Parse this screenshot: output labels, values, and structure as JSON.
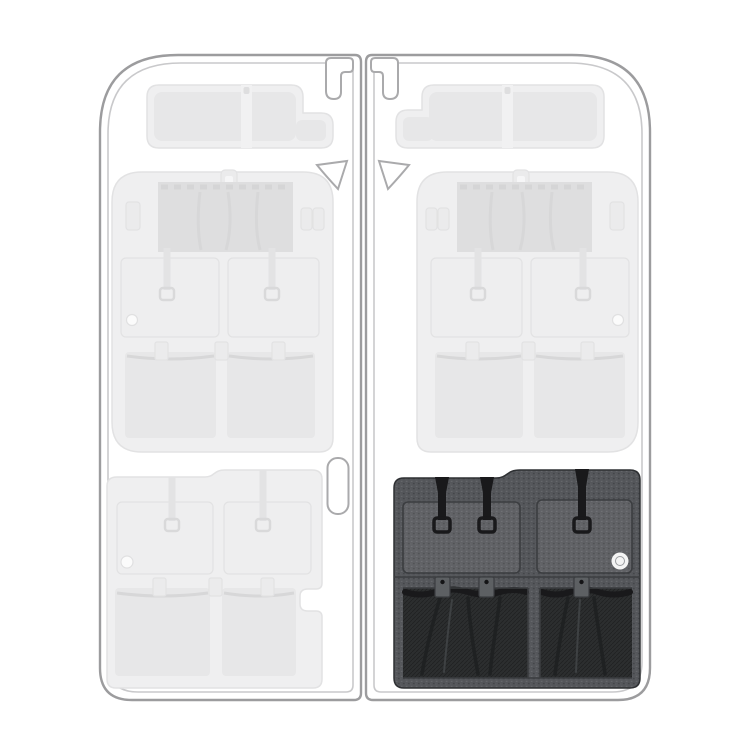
{
  "image": {
    "width": 750,
    "height": 750,
    "kind": "van-rear-door-organizer-placement-diagram"
  },
  "doors": {
    "left": {
      "state": "ghosted",
      "panels": [
        "top-shelf-organizer",
        "middle-door-organizer",
        "bottom-door-organizer"
      ],
      "hardware": [
        "door-check-bracket",
        "wedge-bumper",
        "handle-recess"
      ]
    },
    "right": {
      "state": "ghosted",
      "panels": [
        "top-shelf-organizer",
        "middle-door-organizer"
      ],
      "highlighted_panel": "bottom-door-organizer",
      "hardware": [
        "door-check-bracket",
        "wedge-bumper"
      ]
    }
  },
  "highlighted_panel": {
    "position": "right-door-bottom",
    "features": [
      "flap-pocket-left",
      "flap-pocket-right",
      "webbing-straps",
      "strap-loops",
      "brand-badge",
      "mesh-pocket-left",
      "mesh-pocket-right",
      "snap-tabs"
    ]
  },
  "badge": {
    "shape": "circle"
  },
  "colors": {
    "background": "#ffffff",
    "door_outline": "#9c9c9e",
    "door_outline_inner": "#c9c9cb",
    "hardware_stroke": "#aaaaac",
    "ghost_fill": "#efeff0",
    "ghost_inner": "#e7e7e8",
    "ghost_accent": "#dededf",
    "ghost_stroke": "#e2e2e3",
    "panel_fabric": "#54565a",
    "panel_pocket": "#5d6063",
    "panel_seam": "#3b3d40",
    "mesh_dark": "#2c2e2f",
    "mesh_fold": "#1f2122",
    "strap_black": "#19191b",
    "badge_fill": "#f4f4f4"
  }
}
